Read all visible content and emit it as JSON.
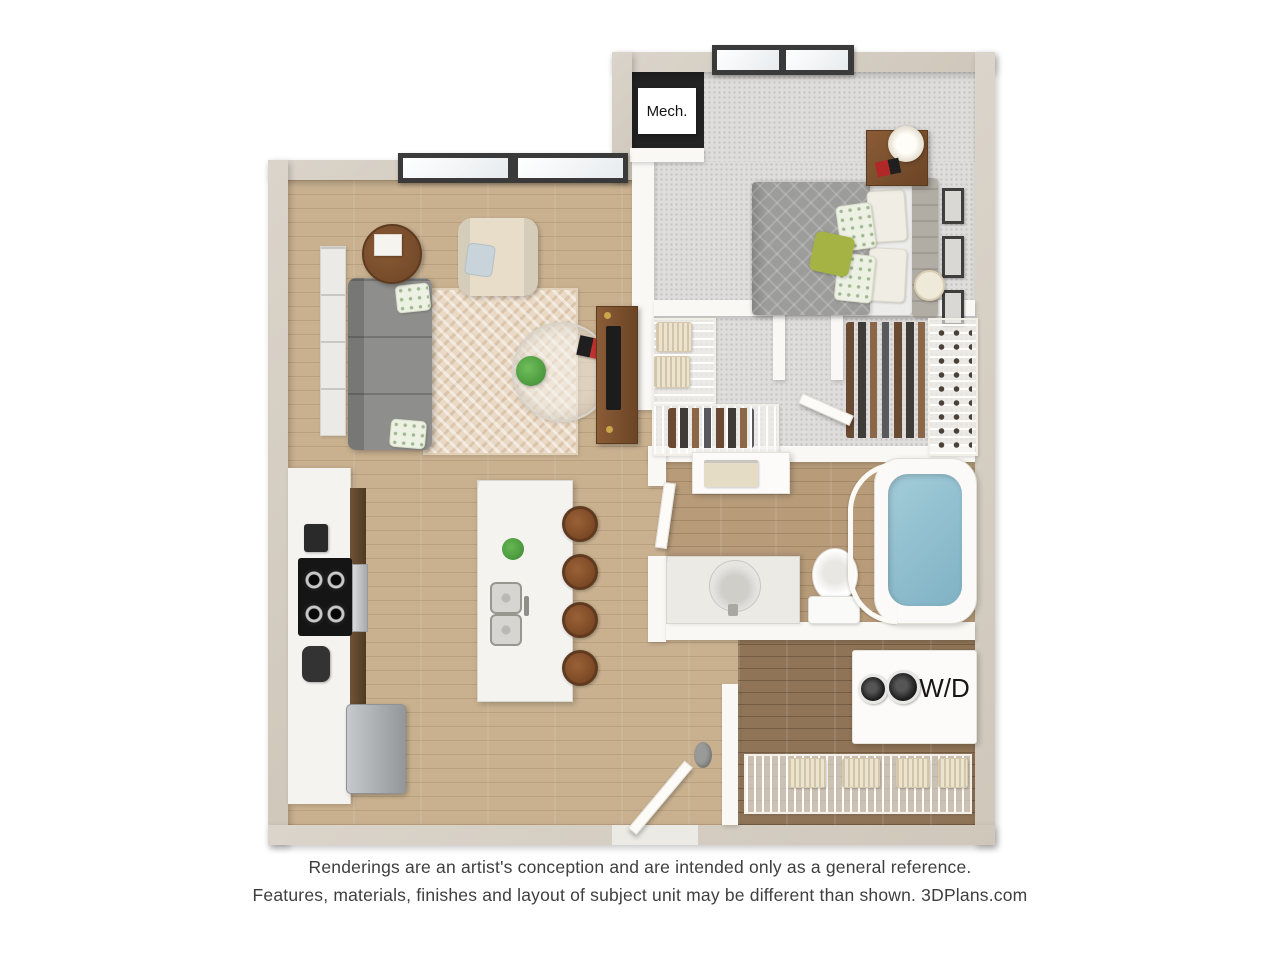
{
  "page": {
    "background": "#ffffff"
  },
  "floorplan": {
    "labels": {
      "mech": "Mech.",
      "washer_dryer": "W/D"
    },
    "colors": {
      "outer_wall": "#d5cec3",
      "inner_wall": "#faf8f5",
      "wood_floor": "#c9b190",
      "wood_floor_bath": "#b89c7a",
      "wood_floor_dark": "#8f7457",
      "carpet": "#dedddb",
      "mech_floor": "#232323",
      "rug": "#ead9c4",
      "sofa": "#8e8e8c",
      "armchair": "#e7ddc9",
      "counter": "#f4f3f0",
      "stool": "#8a5732",
      "wood_furniture": "#7a5130",
      "tv": "#1c1c1c",
      "bed": "#9c9c9a",
      "headboard": "#b2ada4",
      "pillow_green": "#a5b244",
      "tub_water": "#87b8ca",
      "plant": "#4e9b41",
      "window_frame": "#3a3a3a",
      "text": "#3e3e3e"
    }
  },
  "disclaimer": {
    "line1": "Renderings are an artist's conception and are intended only as a general reference.",
    "line2": "Features, materials, finishes and layout of subject unit may be different than shown. 3DPlans.com"
  }
}
